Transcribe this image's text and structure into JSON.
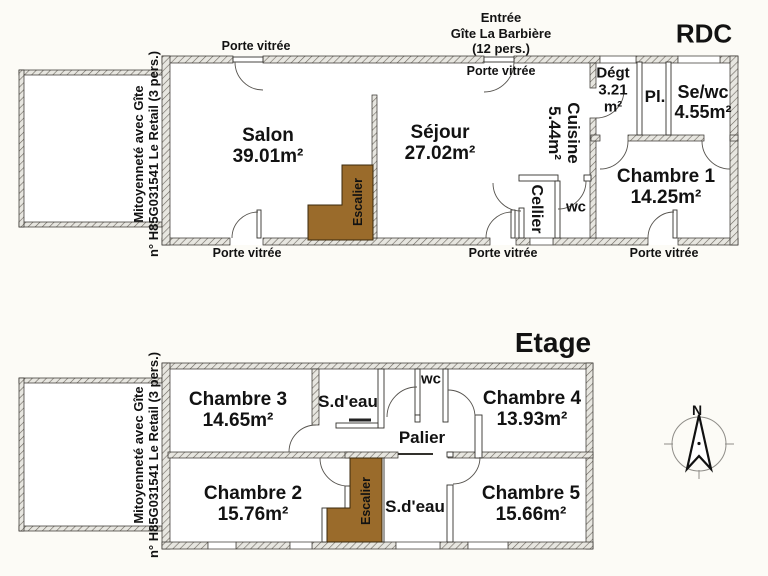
{
  "shared_wall": {
    "line1": "Mitoyenneté avec Gîte",
    "line2": "n° H85G031541 Le Retail (3 pers.)"
  },
  "rdc": {
    "title": "RDC",
    "entrance": {
      "line1": "Entrée",
      "line2": "Gîte La Barbière",
      "line3": "(12 pers.)"
    },
    "glass_door_label": "Porte vitrée",
    "rooms": {
      "salon": {
        "name": "Salon",
        "area": "39.01m²"
      },
      "sejour": {
        "name": "Séjour",
        "area": "27.02m²"
      },
      "cuisine": {
        "name": "Cuisine",
        "area": "5.44m²"
      },
      "cellier": {
        "name": "Cellier"
      },
      "wc": {
        "name": "wc"
      },
      "degagement": {
        "name": "Dégt",
        "area_line1": "3.21",
        "area_line2": "m²"
      },
      "placard": {
        "name": "Pl."
      },
      "shower_wc": {
        "name": "Se/wc",
        "area": "4.55m²"
      },
      "chambre1": {
        "name": "Chambre 1",
        "area": "14.25m²"
      },
      "escalier": {
        "name": "Escalier"
      }
    }
  },
  "etage": {
    "title": "Etage",
    "rooms": {
      "chambre3": {
        "name": "Chambre 3",
        "area": "14.65m²"
      },
      "sdeau_top": {
        "name": "S.d'eau"
      },
      "wc": {
        "name": "wc"
      },
      "chambre4": {
        "name": "Chambre 4",
        "area": "13.93m²"
      },
      "palier": {
        "name": "Palier"
      },
      "chambre2": {
        "name": "Chambre 2",
        "area": "15.76m²"
      },
      "sdeau_bottom": {
        "name": "S.d'eau"
      },
      "chambre5": {
        "name": "Chambre 5",
        "area": "15.66m²"
      },
      "escalier": {
        "name": "Escalier"
      }
    }
  },
  "compass": {
    "north": "N"
  },
  "colors": {
    "stairs": "#9A6B2B",
    "wall_hatch_line": "#6b665e",
    "wall_hatch_bg": "#e7e6e0"
  }
}
